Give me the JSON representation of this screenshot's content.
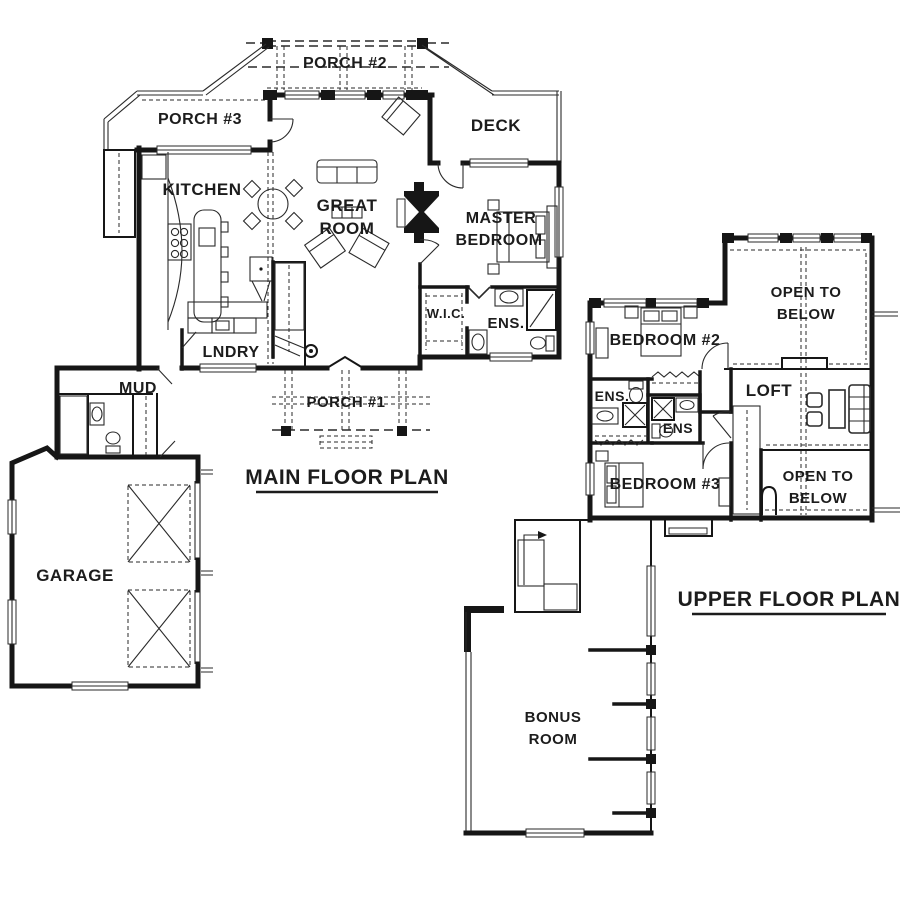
{
  "document": {
    "kind": "architectural floor plan drawing",
    "background_color": "#ffffff",
    "ink_color": "#161616"
  },
  "main_floor": {
    "title": "MAIN FLOOR PLAN",
    "rooms": {
      "porch2": "PORCH #2",
      "porch3": "PORCH #3",
      "deck": "DECK",
      "kitchen": "KITCHEN",
      "great_room": [
        "GREAT",
        "ROOM"
      ],
      "master_bedroom": [
        "MASTER",
        "BEDROOM"
      ],
      "wic": "W.I.C.",
      "ens": "ENS.",
      "lndry": "LNDRY",
      "mud": "MUD",
      "porch1": "PORCH #1",
      "garage": "GARAGE"
    }
  },
  "upper_floor": {
    "title": "UPPER FLOOR PLAN",
    "rooms": {
      "open_to_below_top": [
        "OPEN TO",
        "BELOW"
      ],
      "bedroom2": "BEDROOM #2",
      "loft": "LOFT",
      "ens_left": "ENS.",
      "ens_right": "ENS",
      "bedroom3": "BEDROOM #3",
      "open_to_below_bottom": [
        "OPEN TO",
        "BELOW"
      ],
      "bonus_room": [
        "BONUS",
        "ROOM"
      ]
    }
  }
}
